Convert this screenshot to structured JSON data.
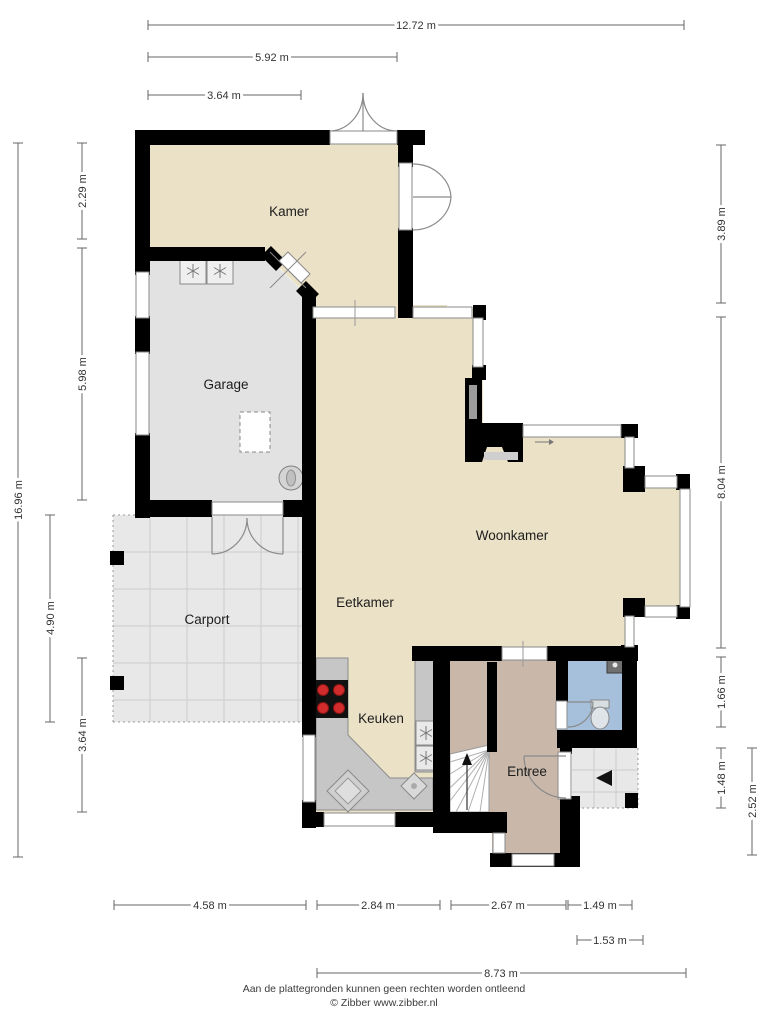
{
  "rooms": {
    "kamer": {
      "label": "Kamer"
    },
    "garage": {
      "label": "Garage"
    },
    "carport": {
      "label": "Carport"
    },
    "eetkamer": {
      "label": "Eetkamer"
    },
    "woonkamer": {
      "label": "Woonkamer"
    },
    "keuken": {
      "label": "Keuken"
    },
    "entree": {
      "label": "Entree"
    }
  },
  "dims": {
    "t1": {
      "label": "12.72 m"
    },
    "t2": {
      "label": "5.92 m"
    },
    "t3": {
      "label": "3.64 m"
    },
    "l1": {
      "label": "16.96 m"
    },
    "l2": {
      "label": "2.29 m"
    },
    "l3": {
      "label": "5.98 m"
    },
    "l4": {
      "label": "4.90 m"
    },
    "l5": {
      "label": "3.64 m"
    },
    "r1": {
      "label": "3.89 m"
    },
    "r2": {
      "label": "8.04 m"
    },
    "r3": {
      "label": "1.66 m"
    },
    "r4": {
      "label": "1.48 m"
    },
    "r5": {
      "label": "2.52 m"
    },
    "b1": {
      "label": "4.58 m"
    },
    "b2": {
      "label": "2.84 m"
    },
    "b3": {
      "label": "2.67 m"
    },
    "b4": {
      "label": "1.49 m"
    },
    "b5": {
      "label": "1.53 m"
    },
    "b6": {
      "label": "8.73 m"
    }
  },
  "footer": {
    "disclaimer": "Aan de plattegronden kunnen geen rechten worden ontleend",
    "credit": "© Zibber www.zibber.nl"
  },
  "colors": {
    "floor_living": "#EAE1C6",
    "floor_garage": "#E2E2E2",
    "floor_carport": "#E8E8E8",
    "floor_porch": "#E8E8E8",
    "floor_entree": "#C9B8A9",
    "floor_toilet": "#A6C0DC",
    "wall": "#000000",
    "counter": "#C6C6C6",
    "stove_burner": "#D22B2B",
    "dimension_text": "#333333"
  }
}
